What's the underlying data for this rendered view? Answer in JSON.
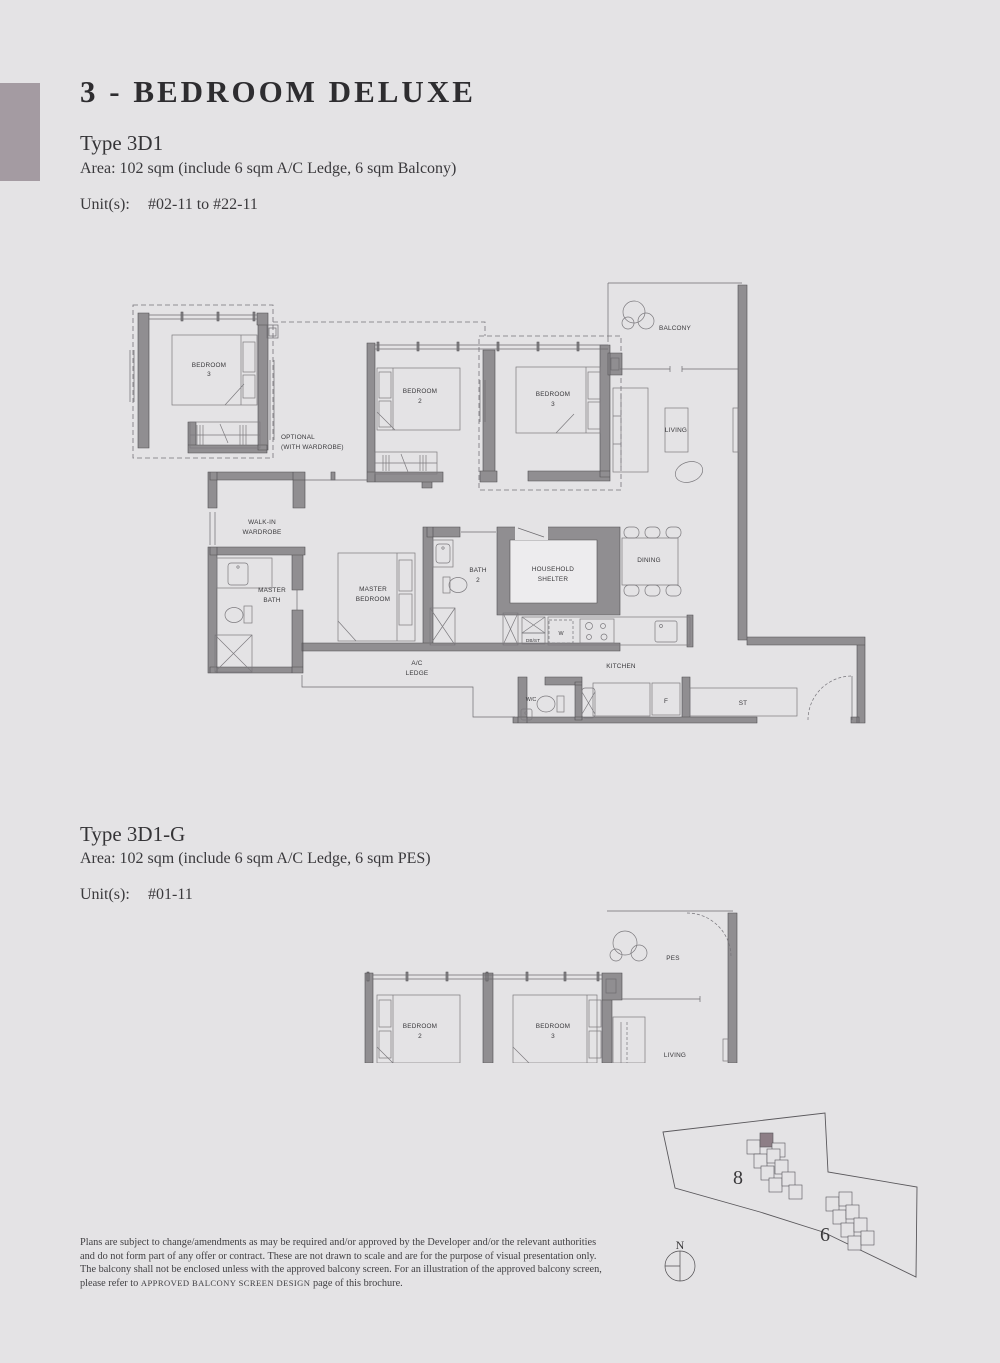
{
  "header": {
    "title": "3 - BEDROOM DELUXE"
  },
  "type1": {
    "name": "Type 3D1",
    "area": "Area: 102 sqm (include 6 sqm A/C Ledge, 6 sqm Balcony)",
    "units_label": "Unit(s):",
    "units_value": "#02-11 to #22-11"
  },
  "type2": {
    "name": "Type 3D1-G",
    "area": "Area: 102 sqm (include 6 sqm A/C Ledge, 6 sqm PES)",
    "units_label": "Unit(s):",
    "units_value": "#01-11"
  },
  "plan1": {
    "opt_bed_l1": "BEDROOM",
    "opt_bed_l2": "3",
    "optional_l1": "OPTIONAL",
    "optional_l2": "(WITH WARDROBE)",
    "bed2_l1": "BEDROOM",
    "bed2_l2": "2",
    "bed3_l1": "BEDROOM",
    "bed3_l2": "3",
    "balcony": "BALCONY",
    "living": "LIVING",
    "walkin_l1": "WALK-IN",
    "walkin_l2": "WARDROBE",
    "mbath_l1": "MASTER",
    "mbath_l2": "BATH",
    "mbed_l1": "MASTER",
    "mbed_l2": "BEDROOM",
    "bath2_l1": "BATH",
    "bath2_l2": "2",
    "hshelter_l1": "HOUSEHOLD",
    "hshelter_l2": "SHELTER",
    "dining": "DINING",
    "dbst": "DB/ST",
    "washer": "W",
    "acledge_l1": "A/C",
    "acledge_l2": "LEDGE",
    "kitchen": "KITCHEN",
    "wc": "W/C",
    "fridge": "F",
    "store": "ST"
  },
  "plan2": {
    "bed2_l1": "BEDROOM",
    "bed2_l2": "2",
    "bed3_l1": "BEDROOM",
    "bed3_l2": "3",
    "pes": "PES",
    "living": "LIVING"
  },
  "siteplan": {
    "block_a": "8",
    "block_b": "6",
    "north": "N",
    "highlight_color": "#8d7e86"
  },
  "disclaimer": {
    "line1": "Plans are subject to change/amendments as may be required and/or approved by the Developer and/or the relevant authorities",
    "line2": "and do not form part of any offer or contract. These are not drawn to scale and are for the purpose of visual presentation only.",
    "line3": "The balcony shall not be enclosed unless with the approved balcony screen. For an illustration of the approved balcony screen,",
    "line4_pre": "please refer to ",
    "line4_caps": "APPROVED BALCONY SCREEN DESIGN",
    "line4_post": " page of this brochure."
  }
}
